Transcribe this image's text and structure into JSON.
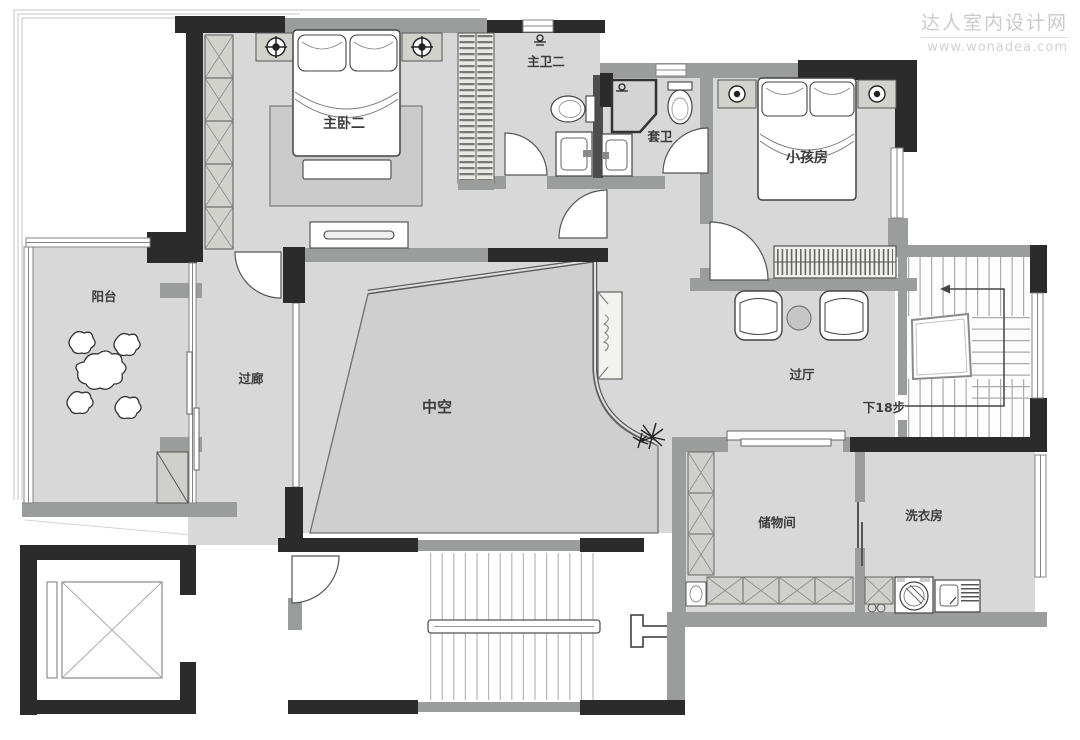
{
  "watermark": {
    "line1": "达人室内设计网",
    "line2": "www.wonadea.com"
  },
  "rooms": {
    "master_bedroom": "主卧二",
    "master_bath": "主卫二",
    "ensuite_bath": "套卫",
    "kids_room": "小孩房",
    "balcony": "阳台",
    "corridor": "过廊",
    "void": "中空",
    "hall": "过厅",
    "storage": "储物间",
    "laundry": "洗衣房"
  },
  "annotations": {
    "stairs_down": "下18步"
  },
  "colors": {
    "wall_structural": "#2b2b2b",
    "wall_partition": "#9b9d9c",
    "floor": "#d8d8d8",
    "void_floor": "#cfcfcf",
    "watermark_text": "#cbcbcb"
  }
}
